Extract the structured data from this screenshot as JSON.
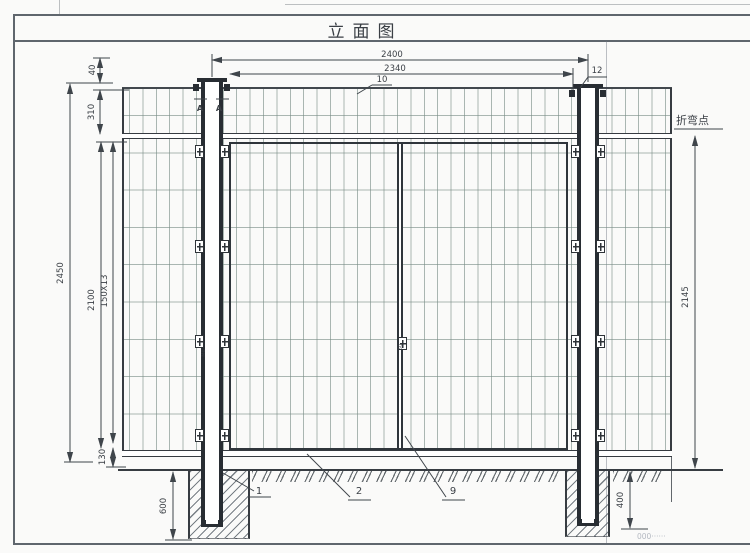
{
  "title": "立面图",
  "dimensions": {
    "top_overall": "2400",
    "top_inner": "2340",
    "mesh_wire": "10",
    "post_edge": "12",
    "top_cap_gap": "40",
    "bend_offset": "310",
    "overall_height": "2450",
    "panel_height": "2100",
    "mesh_opening": "150X13",
    "bottom_gap": "130",
    "left_footing_depth": "600",
    "right_footing_depth": "400",
    "bend_to_ground": "2145"
  },
  "labels": {
    "bend_point": "折弯点",
    "section_a_left": "A",
    "section_a_right": "A",
    "part_1": "1",
    "part_2": "2",
    "part_9": "9",
    "post_bolt": "M8",
    "divider_mark": "60",
    "corner_note": "000······"
  },
  "colors": {
    "drawing_line": "#3f454b",
    "mesh_wire": "#788c85",
    "frame": "#2f353b"
  }
}
